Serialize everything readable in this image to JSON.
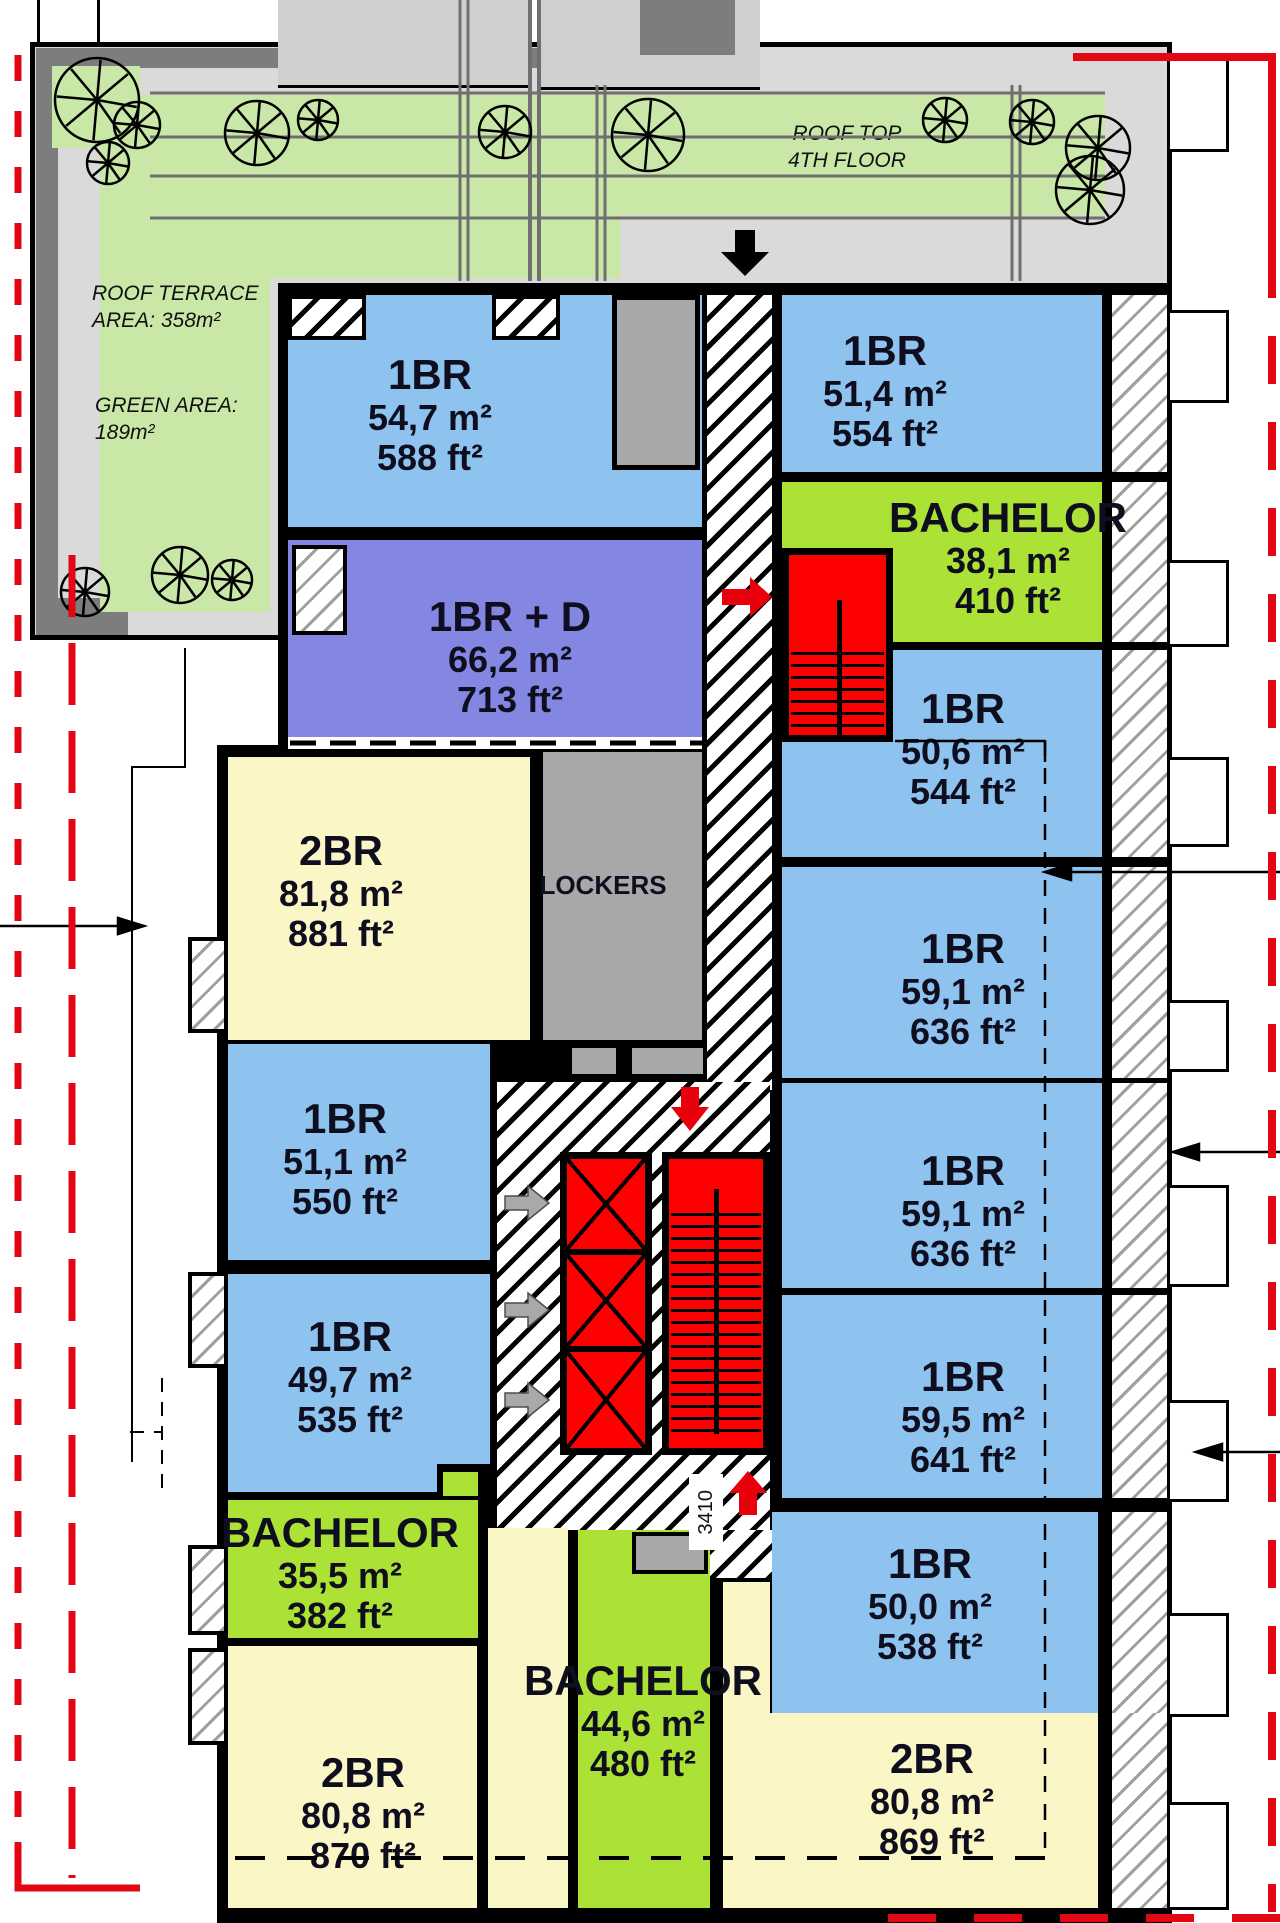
{
  "page_title": "Roof Top 4th Floor Plan",
  "palette": {
    "unit_1br_blue": "#8FC3EF",
    "unit_1br_d_purple": "#8487E2",
    "unit_2br_yellow": "#FAF6C5",
    "unit_bachelor_green": "#ACE136",
    "stair_red": "#FF0000",
    "terrace_gray": "#DADADA",
    "terrace_dark_gray": "#7D7D7D",
    "terrace_green": "#C9E7A6",
    "locker_gray": "#A8A8A8",
    "boundary_red": "#E30613",
    "wall_black": "#000000"
  },
  "terrace": {
    "roof_terrace_line1": "ROOF TERRACE",
    "roof_terrace_line2": "AREA: 358m²",
    "green_area_line1": "GREEN AREA:",
    "green_area_line2": "189m²",
    "roof_top_line1": "ROOF TOP",
    "roof_top_line2": "4TH FLOOR"
  },
  "core": {
    "lockers_label": "LOCKERS",
    "stair_dimension": "3410"
  },
  "units": [
    {
      "id": "1br-54",
      "type": "1BR",
      "area_m2": "54,7 m²",
      "area_ft2": "588 ft²"
    },
    {
      "id": "1br-51-4",
      "type": "1BR",
      "area_m2": "51,4 m²",
      "area_ft2": "554 ft²"
    },
    {
      "id": "bachelor-38",
      "type": "BACHELOR",
      "area_m2": "38,1 m²",
      "area_ft2": "410 ft²"
    },
    {
      "id": "1br-d-66",
      "type": "1BR + D",
      "area_m2": "66,2 m²",
      "area_ft2": "713 ft²"
    },
    {
      "id": "1br-50-6",
      "type": "1BR",
      "area_m2": "50,6 m²",
      "area_ft2": "544 ft²"
    },
    {
      "id": "2br-81",
      "type": "2BR",
      "area_m2": "81,8 m²",
      "area_ft2": "881 ft²"
    },
    {
      "id": "1br-59-1a",
      "type": "1BR",
      "area_m2": "59,1 m²",
      "area_ft2": "636 ft²"
    },
    {
      "id": "1br-51-1",
      "type": "1BR",
      "area_m2": "51,1 m²",
      "area_ft2": "550 ft²"
    },
    {
      "id": "1br-59-1b",
      "type": "1BR",
      "area_m2": "59,1 m²",
      "area_ft2": "636 ft²"
    },
    {
      "id": "1br-49-7",
      "type": "1BR",
      "area_m2": "49,7 m²",
      "area_ft2": "535 ft²"
    },
    {
      "id": "1br-59-5",
      "type": "1BR",
      "area_m2": "59,5 m²",
      "area_ft2": "641 ft²"
    },
    {
      "id": "bachelor-35",
      "type": "BACHELOR",
      "area_m2": "35,5 m²",
      "area_ft2": "382 ft²"
    },
    {
      "id": "1br-50-0",
      "type": "1BR",
      "area_m2": "50,0 m²",
      "area_ft2": "538 ft²"
    },
    {
      "id": "bachelor-44",
      "type": "BACHELOR",
      "area_m2": "44,6 m²",
      "area_ft2": "480 ft²"
    },
    {
      "id": "2br-80-870",
      "type": "2BR",
      "area_m2": "80,8 m²",
      "area_ft2": "870 ft²"
    },
    {
      "id": "2br-80-869",
      "type": "2BR",
      "area_m2": "80,8 m²",
      "area_ft2": "869 ft²"
    }
  ]
}
